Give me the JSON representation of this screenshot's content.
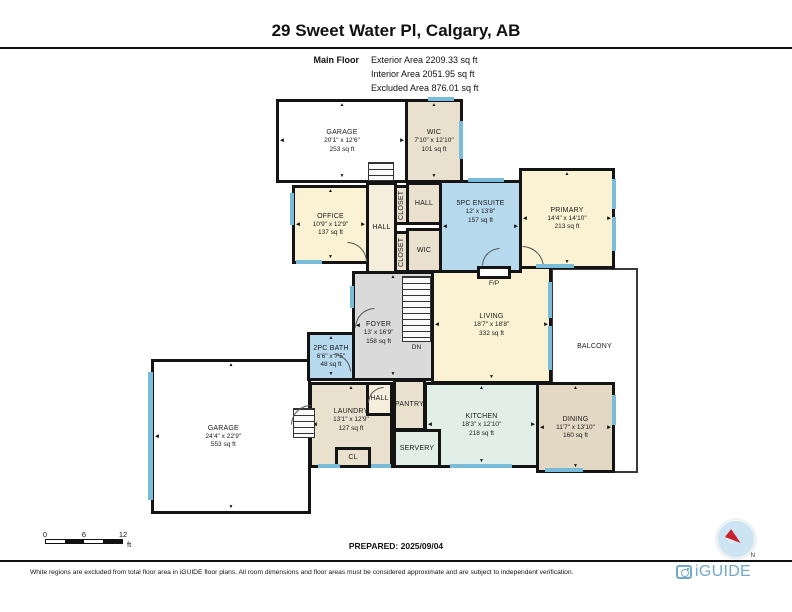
{
  "header": {
    "title": "29 Sweet Water Pl, Calgary, AB",
    "floor_label": "Main Floor",
    "areas": [
      "Exterior Area 2209.33 sq ft",
      "Interior Area 2051.95 sq ft",
      "Excluded Area 876.01 sq ft"
    ]
  },
  "footer": {
    "scale": {
      "ticks": [
        "0",
        "6",
        "12"
      ],
      "unit": "ft"
    },
    "prepared": "PREPARED: 2025/09/04",
    "compass_label": "N",
    "disclaimer": "White regions are excluded from total floor area in iGUIDE floor plans. All room dimensions and floor areas must be considered approximate and are subject to independent verification.",
    "brand": "iGUIDE"
  },
  "colors": {
    "cream": "#FAF2D3",
    "beige": "#E9E0CE",
    "tan": "#E2D8C4",
    "blue": "#B7D9EE",
    "gray": "#DADADA",
    "mint": "#E2EFE8",
    "pale": "#F5EEDC",
    "white": "#FFFFFF",
    "window": "#79BCD9",
    "wall": "#141414",
    "accent": "#6FA8C9",
    "needle": "#C8232C"
  },
  "plan": {
    "fp_label": "F/P",
    "dn_label": "DN",
    "rooms": [
      {
        "id": "balcony",
        "name": "BALCONY",
        "fill": "white",
        "thin": true,
        "rect": [
          551,
          268,
          87,
          205
        ],
        "lbox": [
          0,
          8,
          100,
          60
        ]
      },
      {
        "id": "garage-main",
        "name": "GARAGE",
        "dim": "24'4\" x 22'9\"",
        "area": "553 sq ft",
        "fill": "white",
        "rect": [
          151,
          359,
          160,
          155
        ],
        "lbox": [
          0,
          0,
          90,
          100
        ],
        "arrows": [
          "t",
          "b",
          "l",
          "r"
        ]
      },
      {
        "id": "laundry",
        "name": "LAUNDRY",
        "dim": "13'1\" x 12'9\"",
        "area": "127 sq ft",
        "fill": "beige",
        "rect": [
          309,
          382,
          84,
          86
        ],
        "lbox": [
          0,
          12,
          100,
          64
        ],
        "arrows": [
          "t",
          "b",
          "l"
        ]
      },
      {
        "id": "closet-main",
        "name": "CL",
        "fill": "beige",
        "rect": [
          335,
          447,
          36,
          21
        ]
      },
      {
        "id": "hall-lower",
        "name": "HALL",
        "fill": "pale",
        "rect": [
          366,
          382,
          27,
          34
        ]
      },
      {
        "id": "kitchen",
        "name": "KITCHEN",
        "dim": "18'3\" x 12'10\"",
        "area": "218 sq ft",
        "fill": "mint",
        "rect": [
          424,
          382,
          115,
          86
        ],
        "arrows": [
          "t",
          "b",
          "l",
          "r"
        ]
      },
      {
        "id": "servery",
        "name": "SERVERY",
        "fill": "mint",
        "rect": [
          393,
          429,
          48,
          39
        ]
      },
      {
        "id": "pantry",
        "name": "PANTRY",
        "fill": "beige",
        "rect": [
          393,
          379,
          33,
          52
        ]
      },
      {
        "id": "dining",
        "name": "DINING",
        "dim": "11'7\" x 13'10\"",
        "area": "160 sq ft",
        "fill": "tan",
        "rect": [
          536,
          382,
          79,
          91
        ],
        "arrows": [
          "t",
          "b",
          "l",
          "r"
        ]
      },
      {
        "id": "foyer",
        "name": "FOYER",
        "dim": "13' x 16'9\"",
        "area": "158 sq ft",
        "fill": "gray",
        "rect": [
          352,
          271,
          82,
          110
        ],
        "lbox": [
          0,
          18,
          62,
          78
        ],
        "arrows": [
          "t",
          "b",
          "l"
        ]
      },
      {
        "id": "living",
        "name": "LIVING",
        "dim": "18'7\" x 18'8\"",
        "area": "332 sq ft",
        "fill": "cream",
        "rect": [
          431,
          266,
          121,
          118
        ],
        "arrows": [
          "t",
          "b",
          "l",
          "r"
        ]
      },
      {
        "id": "bath-2pc",
        "name": "2PC BATH",
        "dim": "6'6\" x 7'5\"",
        "area": "48 sq ft",
        "fill": "blue",
        "rect": [
          307,
          332,
          48,
          49
        ],
        "arrows": [
          "t",
          "b"
        ]
      },
      {
        "id": "garage-upper",
        "name": "GARAGE",
        "dim": "20'1\" x 12'6\"",
        "area": "253 sq ft",
        "fill": "white",
        "rect": [
          276,
          99,
          132,
          84
        ],
        "arrows": [
          "t",
          "b",
          "l",
          "r"
        ]
      },
      {
        "id": "wic-upper",
        "name": "WIC",
        "dim": "7'10\" x 12'10\"",
        "area": "101 sq ft",
        "fill": "beige",
        "rect": [
          405,
          99,
          58,
          84
        ],
        "arrows": [
          "t",
          "b"
        ]
      },
      {
        "id": "office",
        "name": "OFFICE",
        "dim": "10'9\" x 12'9\"",
        "area": "137 sq ft",
        "fill": "cream",
        "rect": [
          292,
          185,
          77,
          79
        ],
        "arrows": [
          "t",
          "b",
          "l",
          "r"
        ]
      },
      {
        "id": "hall-corridor",
        "name": "HALL",
        "fill": "pale",
        "rect": [
          366,
          182,
          31,
          92
        ]
      },
      {
        "id": "closet-upper",
        "name": "CLOSET",
        "fill": "beige",
        "vert": true,
        "rect": [
          394,
          185,
          15,
          40
        ]
      },
      {
        "id": "closet-lower",
        "name": "CLOSET",
        "fill": "beige",
        "vert": true,
        "rect": [
          394,
          231,
          15,
          42
        ]
      },
      {
        "id": "hall-mid",
        "name": "HALL",
        "fill": "beige",
        "rect": [
          406,
          182,
          36,
          43
        ]
      },
      {
        "id": "wic-mid",
        "name": "WIC",
        "fill": "beige",
        "rect": [
          406,
          228,
          36,
          45
        ]
      },
      {
        "id": "ensuite",
        "name": "5PC ENSUITE",
        "dim": "12' x 13'8\"",
        "area": "157 sq ft",
        "fill": "blue",
        "rect": [
          439,
          180,
          83,
          93
        ],
        "lbox": [
          0,
          6,
          100,
          55
        ],
        "arrows": [
          "l",
          "r"
        ]
      },
      {
        "id": "primary",
        "name": "PRIMARY",
        "dim": "14'4\" x 14'10\"",
        "area": "213 sq ft",
        "fill": "cream",
        "rect": [
          519,
          168,
          96,
          101
        ],
        "arrows": [
          "t",
          "b",
          "l",
          "r"
        ]
      }
    ],
    "windows": [
      [
        428,
        97,
        26,
        4
      ],
      [
        459,
        121,
        4,
        38
      ],
      [
        290,
        193,
        4,
        32
      ],
      [
        296,
        260,
        26,
        4
      ],
      [
        468,
        178,
        36,
        4
      ],
      [
        612,
        179,
        4,
        30
      ],
      [
        612,
        217,
        4,
        34
      ],
      [
        536,
        264,
        38,
        4
      ],
      [
        548,
        282,
        4,
        36
      ],
      [
        548,
        326,
        4,
        44
      ],
      [
        612,
        395,
        4,
        30
      ],
      [
        545,
        468,
        38,
        4
      ],
      [
        450,
        464,
        62,
        4
      ],
      [
        318,
        464,
        22,
        4
      ],
      [
        371,
        464,
        20,
        4
      ],
      [
        148,
        372,
        5,
        128
      ],
      [
        350,
        286,
        4,
        22
      ]
    ],
    "stairs": [
      {
        "rect": [
          402,
          276,
          29,
          66
        ]
      },
      {
        "rect": [
          368,
          162,
          26,
          19
        ]
      },
      {
        "rect": [
          293,
          408,
          22,
          30
        ]
      }
    ],
    "doors": [
      {
        "x": 355,
        "y": 308,
        "s": 20,
        "c": "tl"
      },
      {
        "x": 347,
        "y": 242,
        "s": 20,
        "c": "tr"
      },
      {
        "x": 522,
        "y": 246,
        "s": 22,
        "c": "tr"
      },
      {
        "x": 482,
        "y": 248,
        "s": 18,
        "c": "tl"
      },
      {
        "x": 333,
        "y": 354,
        "s": 18,
        "c": "tr"
      },
      {
        "x": 291,
        "y": 405,
        "s": 20,
        "c": "tl"
      },
      {
        "x": 368,
        "y": 387,
        "s": 16,
        "c": "tl"
      }
    ],
    "fp_rect": [
      477,
      266,
      34,
      13
    ],
    "fp_label_rect": [
      477,
      280,
      34
    ],
    "dn_rect": [
      402,
      344,
      29
    ]
  }
}
